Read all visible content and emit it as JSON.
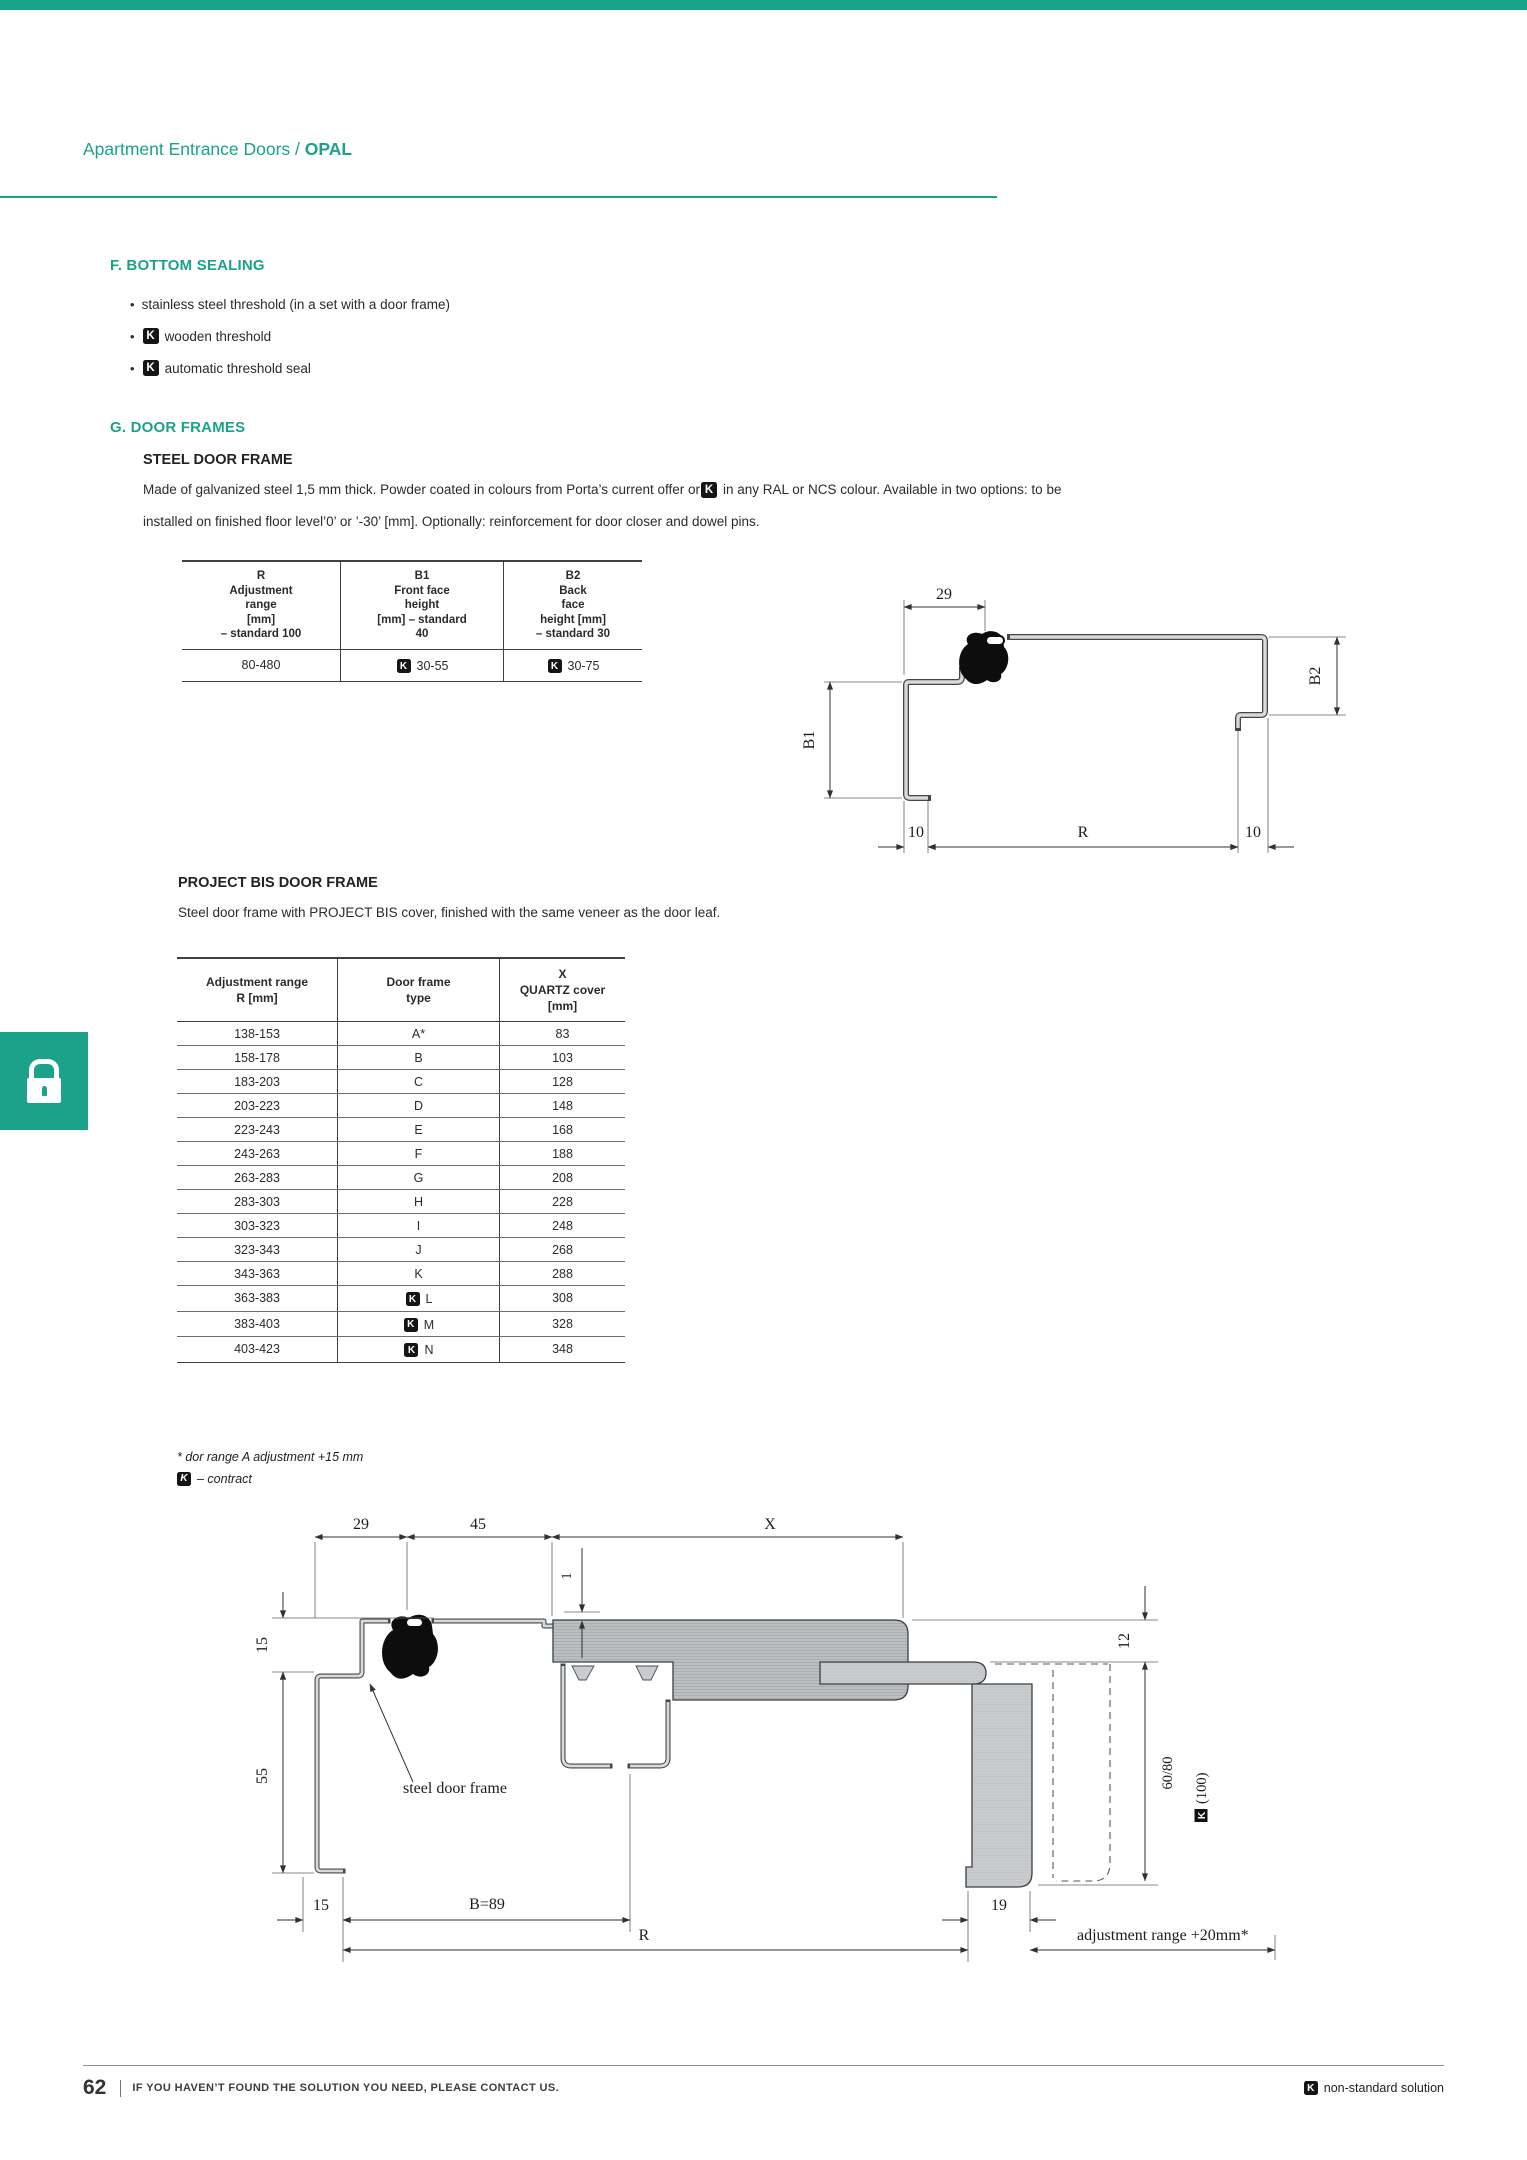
{
  "k_badge": "K",
  "accent_color": "#1CA28B",
  "header": {
    "breadcrumb": "Apartment Entrance Doors /",
    "product": "OPAL"
  },
  "bottom_sealing": {
    "title": "F. BOTTOM SEALING",
    "bullets": [
      {
        "k": false,
        "text": "stainless steel threshold (in a set with a door frame)"
      },
      {
        "k": true,
        "text": "wooden threshold"
      },
      {
        "k": true,
        "text": "automatic threshold seal"
      }
    ]
  },
  "door_frames": {
    "title": "G. DOOR FRAMES",
    "steel_frame": {
      "heading": "STEEL DOOR FRAME",
      "para_line1_a": "Made of galvanized steel 1,5 mm thick. Powder coated in colours from Porta’s current offer or",
      "para_line1_b": "in any RAL or NCS colour. Available in two options: to be",
      "para_line2": "installed on finished floor level’0’ or ’-30’ [mm]. Optionally: reinforcement for door closer and dowel pins.",
      "table": {
        "headers": [
          "R\nAdjustment\nrange\n[mm]\n– standard 100",
          "B1\nFront face\nheight\n[mm] – standard\n40",
          "B2\nBack\nface\nheight [mm]\n– standard 30"
        ],
        "row": {
          "adjustment_range": "80-480",
          "b1": "30-55",
          "b2": "30-75"
        }
      },
      "drawing": {
        "dim_top": "29",
        "dim_left": "B1",
        "dim_right": "B2",
        "dim_bottom_left": "10",
        "dim_bottom_mid": "R",
        "dim_bottom_right": "10"
      }
    },
    "project_bis": {
      "heading": "PROJECT BIS DOOR FRAME",
      "description": "Steel door frame with PROJECT BIS cover, finished with the same veneer as the door leaf.",
      "table": {
        "headers": [
          "Adjustment range\nR [mm]",
          "Door frame\ntype",
          "X\nQUARTZ cover\n[mm]"
        ],
        "rows": [
          {
            "range": "138-153",
            "type": "A*",
            "k": false,
            "x": "83"
          },
          {
            "range": "158-178",
            "type": "B",
            "k": false,
            "x": "103"
          },
          {
            "range": "183-203",
            "type": "C",
            "k": false,
            "x": "128"
          },
          {
            "range": "203-223",
            "type": "D",
            "k": false,
            "x": "148"
          },
          {
            "range": "223-243",
            "type": "E",
            "k": false,
            "x": "168"
          },
          {
            "range": "243-263",
            "type": "F",
            "k": false,
            "x": "188"
          },
          {
            "range": "263-283",
            "type": "G",
            "k": false,
            "x": "208"
          },
          {
            "range": "283-303",
            "type": "H",
            "k": false,
            "x": "228"
          },
          {
            "range": "303-323",
            "type": "I",
            "k": false,
            "x": "248"
          },
          {
            "range": "323-343",
            "type": "J",
            "k": false,
            "x": "268"
          },
          {
            "range": "343-363",
            "type": "K",
            "k": false,
            "x": "288"
          },
          {
            "range": "363-383",
            "type": "L",
            "k": true,
            "x": "308"
          },
          {
            "range": "383-403",
            "type": "M",
            "k": true,
            "x": "328"
          },
          {
            "range": "403-423",
            "type": "N",
            "k": true,
            "x": "348"
          }
        ]
      },
      "footnote_asterisk": "* dor range A adjustment +15 mm",
      "footnote_contract": "– contract",
      "drawing": {
        "dim_29": "29",
        "dim_45": "45",
        "dim_x": "X",
        "dim_1": "1",
        "dim_15_left": "15",
        "dim_55": "55",
        "label_steel_frame": "steel door frame",
        "dim_12": "12",
        "dim_60_80": "60/80",
        "dim_100": "(100)",
        "dim_15_bottom": "15",
        "dim_b": "B=89",
        "dim_r": "R",
        "dim_19": "19",
        "label_adjustment": "adjustment range +20mm*"
      }
    }
  },
  "footer": {
    "page_number": "62",
    "message": "IF YOU HAVEN’T FOUND THE SOLUTION YOU NEED, PLEASE CONTACT US.",
    "non_standard": "non-standard solution"
  }
}
